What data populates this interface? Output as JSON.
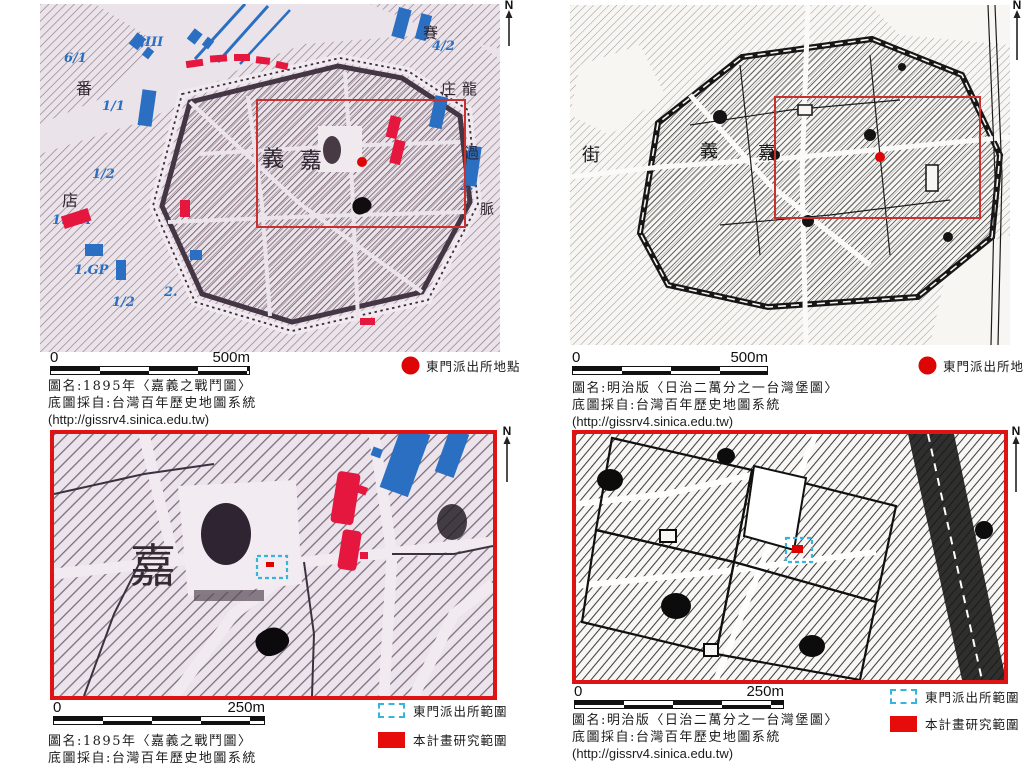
{
  "figure": {
    "description": "Four historical map panels of Chiayi, Taiwan with scale bars, north arrows, legends and captions"
  },
  "colors": {
    "accent_red": "#de1414",
    "mark_red": "#e5173f",
    "dot_red": "#dd0505",
    "annotation_blue": "#2a6fc2",
    "legend_cyan": "#35b4dc"
  },
  "panels": [
    {
      "name": "1895-overview",
      "north": "N",
      "scale": {
        "start": "0",
        "end": "500m"
      },
      "legend": [
        {
          "icon": "red-dot",
          "label": "東門派出所地點"
        }
      ],
      "caption": [
        "圖名:1895年〈嘉義之戰鬥圖〉",
        "底圖採自:台灣百年歷史地圖系統",
        "(http://gissrv4.sinica.edu.tw)"
      ],
      "map_labels": [
        "義",
        "嘉",
        "番",
        "店",
        "賽",
        "庄",
        "龍",
        "過",
        "脈"
      ],
      "blue_annotations": [
        "6/1",
        "合III",
        "1/1",
        "1/2",
        "1.G.A",
        "1.GP",
        "1/2",
        "2.",
        "4/2",
        "2."
      ]
    },
    {
      "name": "meiji-taiwanbao-overview",
      "north": "N",
      "scale": {
        "start": "0",
        "end": "500m"
      },
      "legend": [
        {
          "icon": "red-dot",
          "label": "東門派出所地點"
        }
      ],
      "caption": [
        "圖名:明治版〈日治二萬分之一台灣堡圖〉",
        "底圖採自:台灣百年歷史地圖系統",
        "(http://gissrv4.sinica.edu.tw)"
      ],
      "map_labels": [
        "街",
        "義",
        "嘉"
      ]
    },
    {
      "name": "1895-detail",
      "north": "N",
      "scale": {
        "start": "0",
        "end": "250m"
      },
      "legend": [
        {
          "icon": "dashed-box",
          "label": "東門派出所範圍"
        },
        {
          "icon": "red-box",
          "label": "本計畫研究範圍"
        }
      ],
      "caption": [
        "圖名:1895年〈嘉義之戰鬥圖〉",
        "底圖採自:台灣百年歷史地圖系統"
      ],
      "map_labels": [
        "嘉"
      ]
    },
    {
      "name": "meiji-taiwanbao-detail",
      "north": "N",
      "scale": {
        "start": "0",
        "end": "250m"
      },
      "legend": [
        {
          "icon": "dashed-box",
          "label": "東門派出所範圍"
        },
        {
          "icon": "red-box",
          "label": "本計畫研究範圍"
        }
      ],
      "caption": [
        "圖名:明治版〈日治二萬分之一台灣堡圖〉",
        "底圖採自:台灣百年歷史地圖系統",
        "(http://gissrv4.sinica.edu.tw)"
      ]
    }
  ]
}
